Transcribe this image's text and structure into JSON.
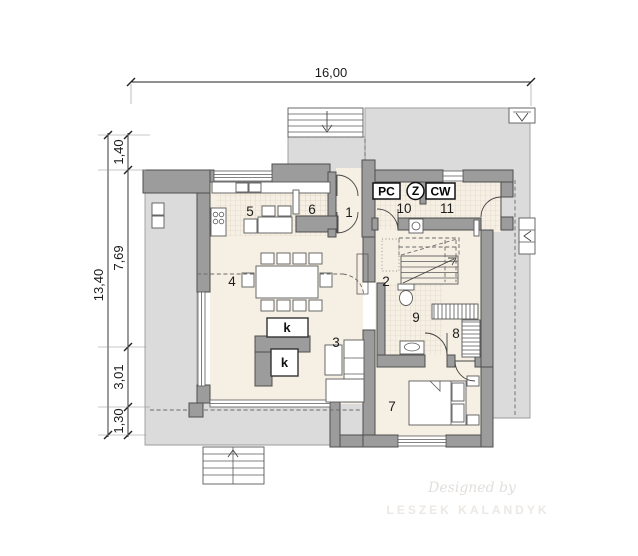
{
  "dimensions": {
    "top_width": "16,00",
    "left_total": "13,40",
    "left_segment_1": "1,40",
    "left_segment_2": "7,69",
    "left_segment_3": "3,01",
    "left_segment_4": "1,30"
  },
  "rooms": [
    {
      "number": "1"
    },
    {
      "number": "2"
    },
    {
      "number": "3"
    },
    {
      "number": "4"
    },
    {
      "number": "5"
    },
    {
      "number": "6"
    },
    {
      "number": "7"
    },
    {
      "number": "8"
    },
    {
      "number": "9"
    },
    {
      "number": "10"
    },
    {
      "number": "11"
    }
  ],
  "equipment_labels": {
    "pc": "PC",
    "z": "Z",
    "cw": "CW",
    "fireplace_upper": "k",
    "fireplace_lower": "k"
  },
  "watermark": {
    "byline": "Designed by",
    "author": "LESZEK KALANDYK"
  },
  "colors": {
    "wall": "#9c9c9c",
    "wall_outline": "#4e4e4e",
    "exterior_surface": "#dbdbdb",
    "floor": "#f6efe3",
    "tile_line": "#d9cfbf",
    "dimension_text": "#1a1a1a",
    "watermark": "#e8e5e2"
  }
}
